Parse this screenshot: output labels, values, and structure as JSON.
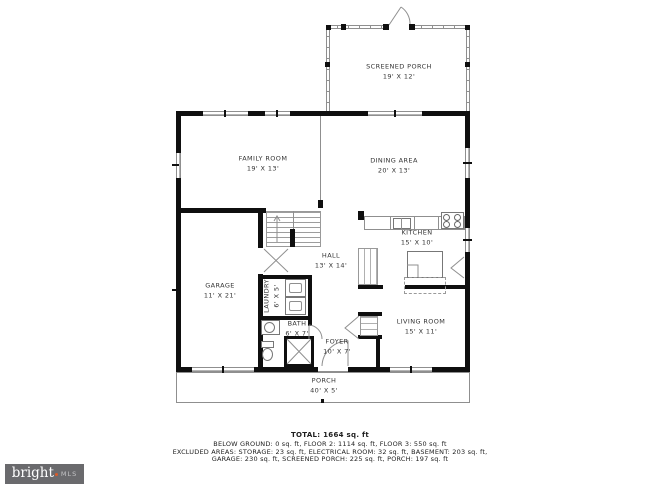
{
  "plan": {
    "rooms": [
      {
        "id": "screened-porch",
        "name": "SCREENED PORCH",
        "dims": "19' X 12'"
      },
      {
        "id": "family-room",
        "name": "FAMILY ROOM",
        "dims": "19' X 13'"
      },
      {
        "id": "dining-area",
        "name": "DINING AREA",
        "dims": "20' X 13'"
      },
      {
        "id": "kitchen",
        "name": "KITCHEN",
        "dims": "15' X 10'"
      },
      {
        "id": "hall",
        "name": "HALL",
        "dims": "13' X 14'"
      },
      {
        "id": "garage",
        "name": "GARAGE",
        "dims": "11' X 21'"
      },
      {
        "id": "laundry",
        "name": "LAUNDRY",
        "dims": "6' X 5'"
      },
      {
        "id": "bath",
        "name": "BATH",
        "dims": "6' X 7'"
      },
      {
        "id": "foyer",
        "name": "FOYER",
        "dims": "10' X 7'"
      },
      {
        "id": "living-room",
        "name": "LIVING ROOM",
        "dims": "15' X 11'"
      },
      {
        "id": "porch",
        "name": "PORCH",
        "dims": "40' X 5'"
      }
    ]
  },
  "summary": {
    "total": "TOTAL: 1664 sq. ft",
    "line1": "BELOW GROUND: 0 sq. ft, FLOOR 2: 1114 sq. ft, FLOOR 3: 550 sq. ft",
    "line2": "EXCLUDED AREAS: STORAGE: 23 sq. ft, ELECTRICAL ROOM: 32 sq. ft, BASEMENT: 203 sq. ft,",
    "line3": "GARAGE: 230 sq. ft, SCREENED PORCH: 225 sq. ft, PORCH: 197 sq. ft"
  },
  "branding": {
    "logo_text": "bright",
    "logo_suffix": "MLS"
  },
  "colors": {
    "wall": "#0f0f0f",
    "line": "#8f8f8f",
    "text": "#333333",
    "logo_bg": "#6a6a6d",
    "logo_accent": "#d95b29",
    "logo_mls": "#c4c4c6"
  }
}
